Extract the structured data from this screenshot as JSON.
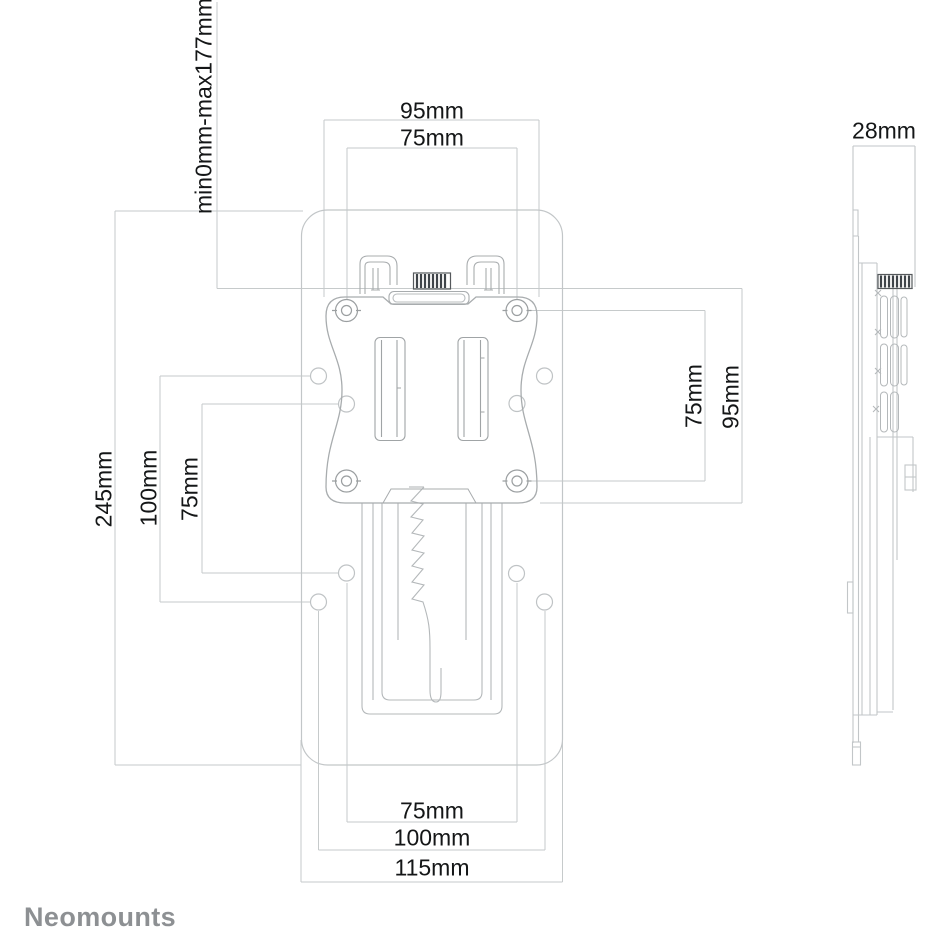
{
  "branding": {
    "logo_text": "Neomounts",
    "logo_color": "#8d9093"
  },
  "drawing": {
    "type": "technical-dimension-drawing",
    "views": [
      "front-view",
      "side-view"
    ],
    "dims": {
      "front_top": {
        "outer": "95mm",
        "inner": "75mm"
      },
      "front_left": {
        "adjust_range": "min0mm-max177mm",
        "height": "245mm",
        "vesa100": "100mm",
        "vesa75": "75mm"
      },
      "front_right": {
        "vesa75": "75mm",
        "plate": "95mm"
      },
      "front_bottom": {
        "vesa75": "75mm",
        "vesa100": "100mm",
        "width": "115mm"
      },
      "side_top": {
        "depth": "28mm"
      }
    }
  },
  "colors": {
    "background": "#ffffff",
    "dimension_line": "#c6cacb",
    "outline_light": "#c2c6c8",
    "outline_medium": "#a8acae",
    "detail": "#9b9fa1",
    "knurl_dark": "#3f4449",
    "text": "#141617",
    "logo": "#8d9093"
  }
}
